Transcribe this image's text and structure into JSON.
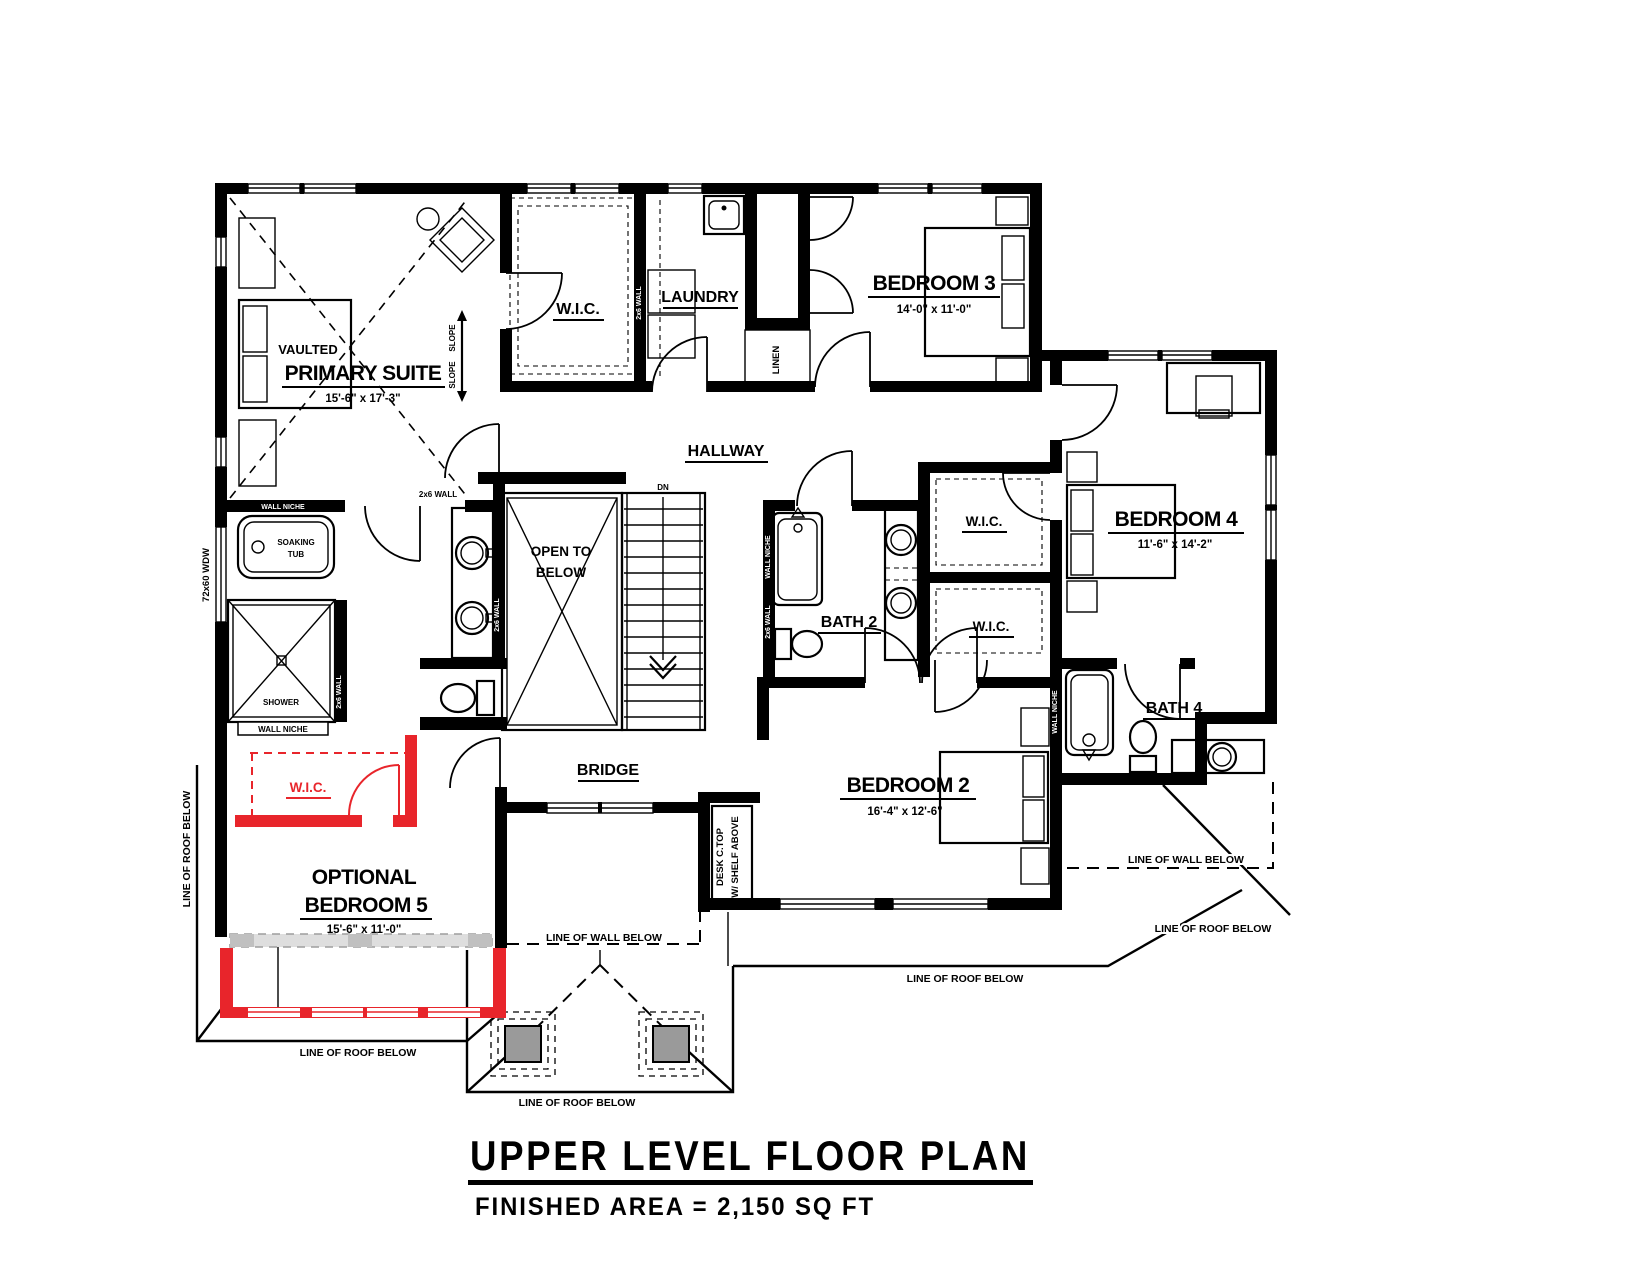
{
  "title": {
    "main": "UPPER LEVEL FLOOR PLAN",
    "area": "FINISHED AREA  =  2,150 SQ FT"
  },
  "rooms": {
    "primary": {
      "tag": "VAULTED",
      "name": "PRIMARY SUITE",
      "dims": "15'-6\" x 17'-3\""
    },
    "wic": {
      "name": "W.I.C."
    },
    "laundry": {
      "name": "LAUNDRY"
    },
    "linen": {
      "name": "LINEN"
    },
    "bedroom3": {
      "name": "BEDROOM 3",
      "dims": "14'-0\" x 11'-0\""
    },
    "bedroom4": {
      "name": "BEDROOM 4",
      "dims": "11'-6\" x 14'-2\""
    },
    "bedroom2": {
      "name": "BEDROOM 2",
      "dims": "16'-4\" x 12'-6\""
    },
    "bedroom5": {
      "tag": "OPTIONAL",
      "name": "BEDROOM 5",
      "dims": "15'-6\" x 11'-0\""
    },
    "hallway": {
      "name": "HALLWAY"
    },
    "bath2": {
      "name": "BATH 2"
    },
    "bath4": {
      "name": "BATH 4"
    },
    "bridge": {
      "name": "BRIDGE"
    },
    "open_below": {
      "line1": "OPEN TO",
      "line2": "BELOW"
    }
  },
  "annotations": {
    "dn": "DN",
    "slope": "SLOPE",
    "shower": "SHOWER",
    "soaking_tub_line1": "SOAKING",
    "soaking_tub_line2": "TUB",
    "wall_niche": "WALL NICHE",
    "wall_2x6": "2x6 WALL",
    "window_72x60": "72x60 WDW",
    "desk_line1": "DESK C.TOP",
    "desk_line2": "W/ SHELF ABOVE",
    "line_of_roof_below": "LINE OF ROOF BELOW",
    "line_of_wall_below": "LINE OF WALL BELOW"
  },
  "colors": {
    "ink": "#000000",
    "optional_red": "#e8252b",
    "removed_gray": "#c0c0c0",
    "post_gray": "#9a9a9a"
  }
}
